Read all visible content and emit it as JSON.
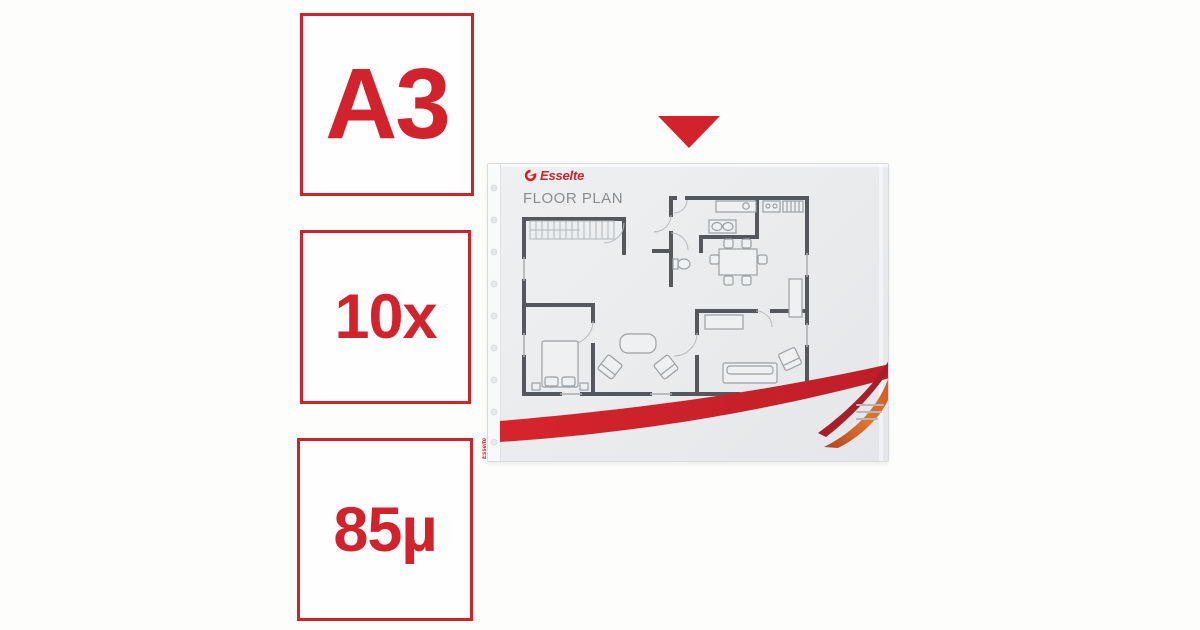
{
  "colors": {
    "accent_red": "#d2232c",
    "swoosh_dark_red": "#a81e28",
    "swoosh_orange": "#e0762f",
    "sleeve_gray": "#eaecee",
    "plan_wall_gray": "#54585c",
    "title_text_gray": "#898d90"
  },
  "badges": [
    {
      "id": "format",
      "label": "A3"
    },
    {
      "id": "count",
      "label": "10x"
    },
    {
      "id": "thickness",
      "label": "85µ"
    }
  ],
  "pointer": {
    "icon": "triangle-down-icon",
    "color": "#d2232c"
  },
  "product": {
    "brand": "Esselte",
    "logo_icon": "esselte-swirl-icon",
    "document_title": "FLOOR PLAN",
    "edge_text": "Esselte",
    "fine_print_lines": 3
  }
}
